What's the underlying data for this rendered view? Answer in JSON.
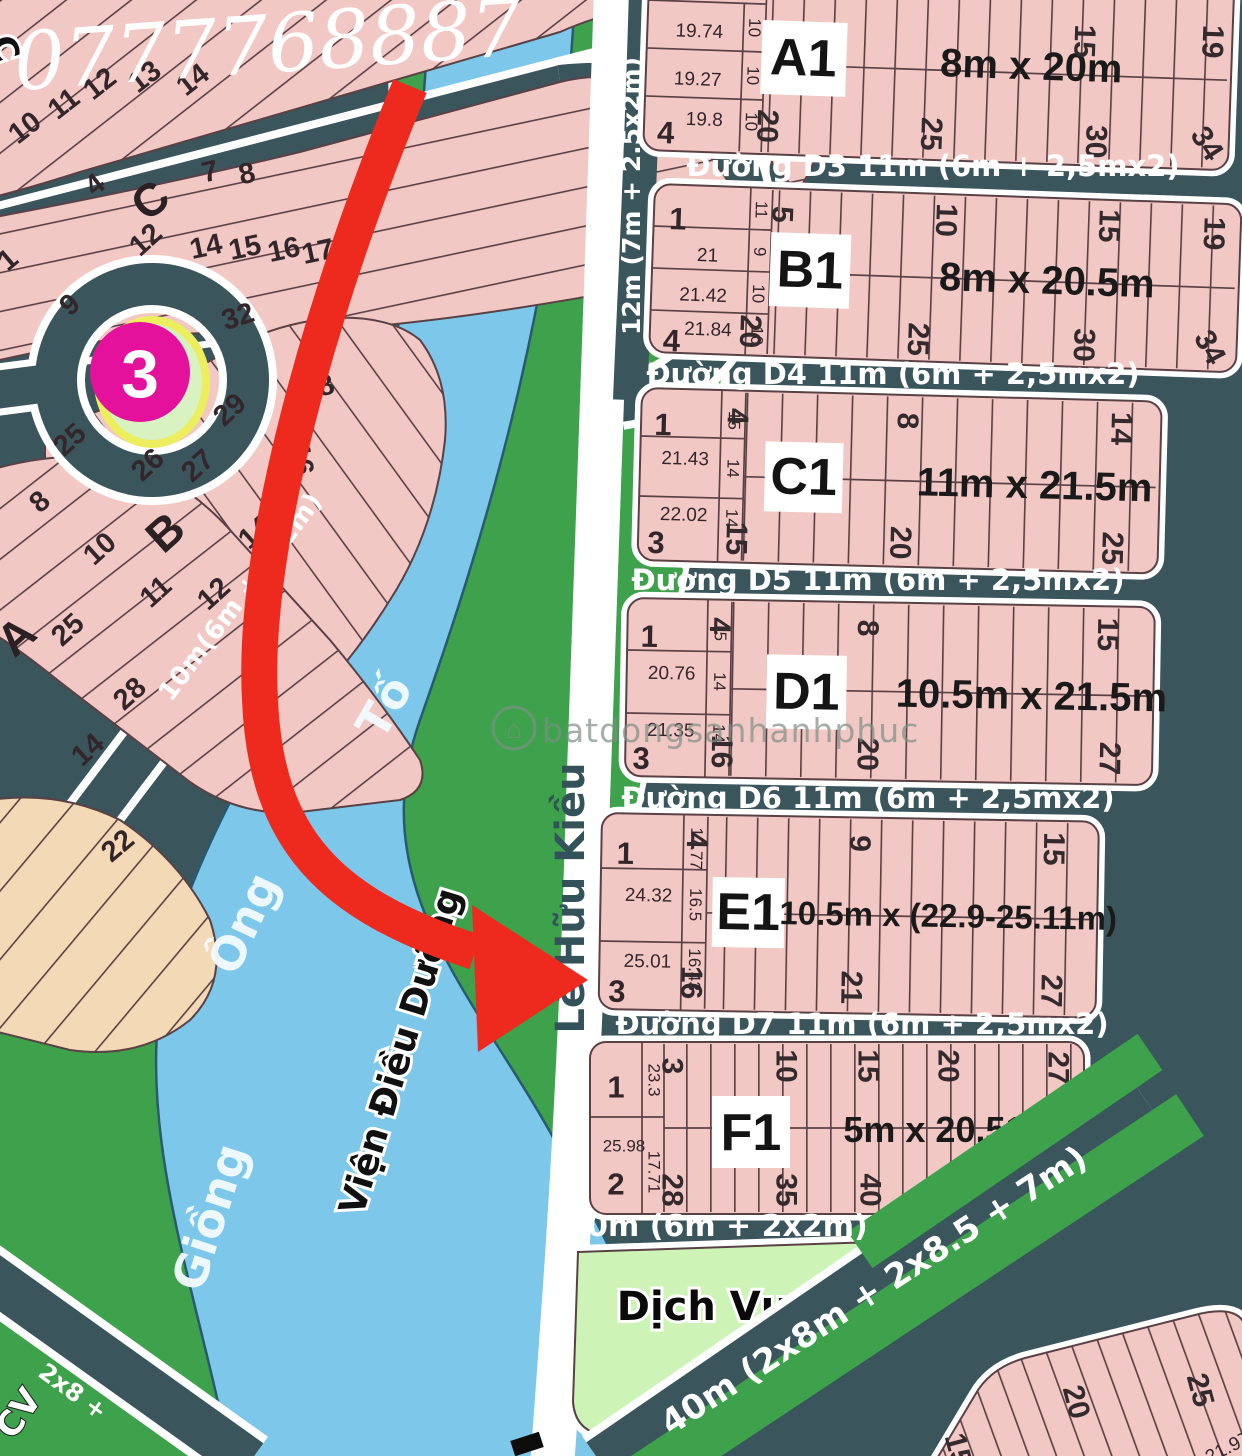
{
  "phone": "0777768887",
  "marker": {
    "number": "3"
  },
  "watermark": {
    "text": "batdongsanhanhphuc",
    "icon": "house-icon"
  },
  "river": {
    "word1": "Giồng",
    "word2": "Ông",
    "word3": "Tố"
  },
  "places": {
    "cv": "CV",
    "dich_vu": "Dịch Vụ",
    "vien_dieu_duong": "Viện Điều Dưỡng",
    "street": "Lê Hữu Kiều"
  },
  "roads": {
    "d3": "Đường D3 11m (6m + 2,5mx2)",
    "d4": "Đường D4 11m (6m + 2,5mx2)",
    "d5": "Đường D5 11m (6m + 2,5mx2)",
    "d6": "Đường D6 11m (6m + 2,5mx2)",
    "d7": "Đường D7 11m (6m + 2,5mx2)",
    "below_f1": "10m (6m + 2x2m)",
    "diagonal": "40m (2x8m + 2x8.5 + 7m)",
    "left_vertical": "12m (7m + 2.5x2m)",
    "between_ab": "10m(6m + 2x2m)",
    "corner_fragment": "2x8 +"
  },
  "blocks": {
    "a1": {
      "label": "A1",
      "dim": "8m x 20m",
      "plot_bottom": "4",
      "rows": [
        {
          "w": "19.74",
          "s": "10"
        },
        {
          "w": "19.27",
          "s": "10"
        },
        {
          "w": "19.8",
          "s": "10"
        }
      ],
      "top_ticks": [
        "15",
        "19"
      ],
      "bottom_ticks": [
        "20",
        "25",
        "30",
        "34"
      ]
    },
    "b1": {
      "label": "B1",
      "dim": "8m x 20.5m",
      "plot_top": "1",
      "side_top": "11",
      "plot_bottom": "4",
      "rows": [
        {
          "w": "21",
          "s": "9"
        },
        {
          "w": "21.42",
          "s": "10"
        },
        {
          "w": "21.84",
          "s": "10"
        }
      ],
      "top_ticks": [
        "5",
        "10",
        "15",
        "19"
      ],
      "bottom_ticks": [
        "20",
        "25",
        "30",
        "34"
      ]
    },
    "c1": {
      "label": "C1",
      "dim": "11m x 21.5m",
      "plot_top": "1",
      "side_top": "15",
      "plot_bottom": "3",
      "rows": [
        {
          "w": "21.43",
          "s": "14"
        },
        {
          "w": "22.02",
          "s": "14"
        }
      ],
      "top_ticks": [
        "4",
        "8",
        "14"
      ],
      "bottom_ticks": [
        "15",
        "20",
        "25"
      ]
    },
    "d1": {
      "label": "D1",
      "dim": "10.5m x 21.5m",
      "plot_top": "1",
      "side_top": "15",
      "plot_bottom": "3",
      "rows": [
        {
          "w": "20.76",
          "s": "14"
        },
        {
          "w": "21.35",
          "s": "14"
        }
      ],
      "top_ticks": [
        "4",
        "8",
        "15"
      ],
      "bottom_ticks": [
        "16",
        "20",
        "27"
      ]
    },
    "e1": {
      "label": "E1",
      "dim": "10.5m x (22.9-25.11m)",
      "plot_top": "1",
      "side_top": "17.77",
      "plot_bottom": "3",
      "rows": [
        {
          "w": "24.32",
          "s": "16.5"
        },
        {
          "w": "25.01",
          "s": "16.43"
        }
      ],
      "top_ticks": [
        "4",
        "9",
        "15"
      ],
      "bottom_ticks": [
        "16",
        "21",
        "27"
      ]
    },
    "f1": {
      "label": "F1",
      "dim": "5m x 20.51~20.57",
      "plot_top": "1",
      "side_top": "23.3",
      "plot_bottom": "2",
      "rows": [
        {
          "w": "25.98",
          "s": "17.71"
        }
      ],
      "top_ticks": [
        "3",
        "10",
        "15",
        "20",
        "27"
      ],
      "bottom_ticks": [
        "28",
        "35",
        "40",
        "45",
        "52"
      ]
    }
  },
  "left_area": {
    "block_c_letter": "C",
    "block_b_letter": "B",
    "block_a_letter": "A",
    "edge_letter": "C",
    "numbers": [
      "10",
      "11",
      "12",
      "13",
      "14",
      "4",
      "7",
      "8",
      "12",
      "14",
      "15",
      "16",
      "17",
      "1",
      "9",
      "32",
      "29",
      "25",
      "26",
      "27",
      "8",
      "10",
      "11",
      "12",
      "8",
      "16",
      "14",
      "25",
      "28",
      "14",
      "22"
    ]
  },
  "bottom_right_block": {
    "ticks": [
      "15",
      "20",
      "25"
    ],
    "width": "21.97"
  }
}
